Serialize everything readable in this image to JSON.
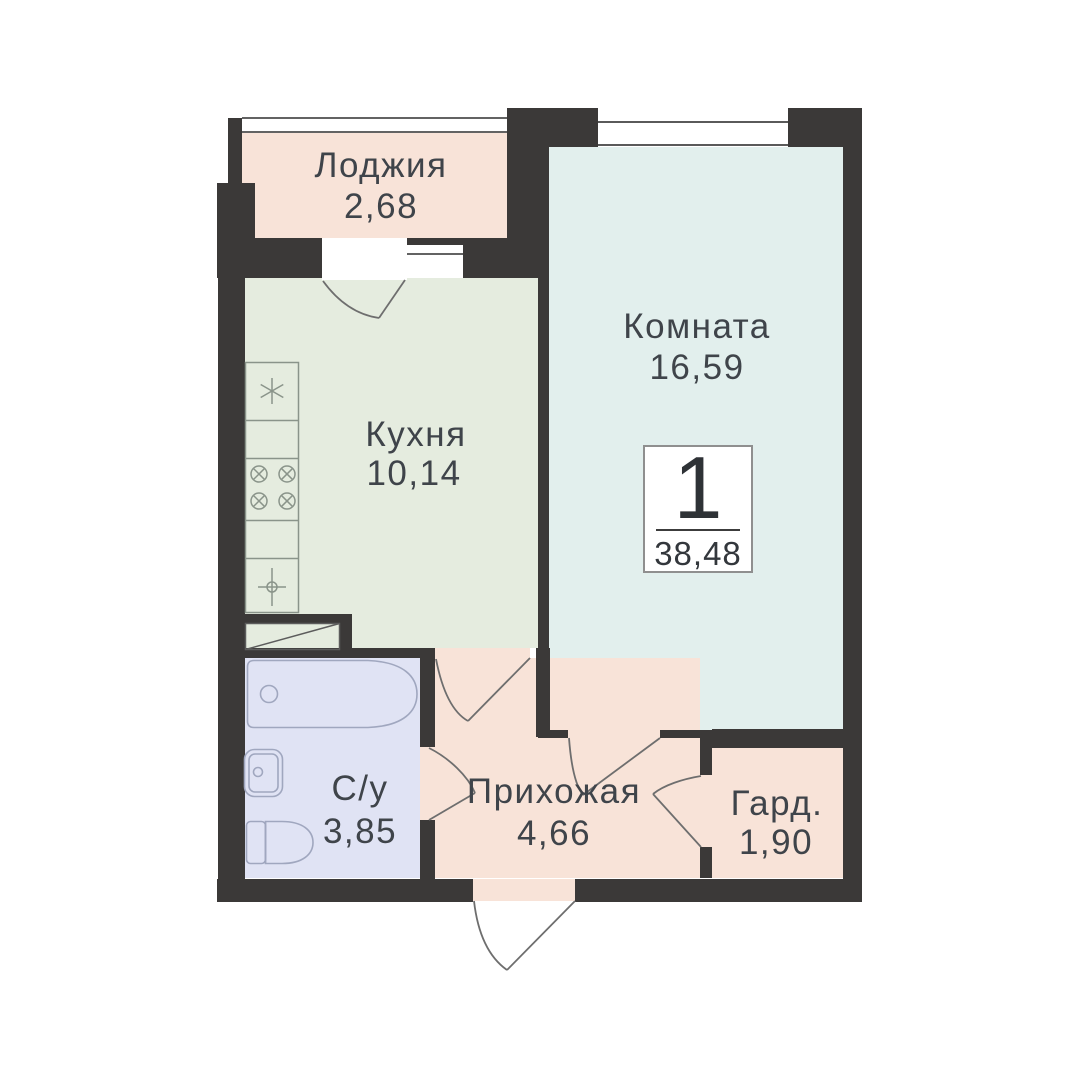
{
  "plan": {
    "type": "apartment-floor-plan",
    "badge": {
      "rooms_count": "1",
      "total_area": "38,48"
    },
    "rooms": [
      {
        "id": "loggia",
        "name": "Лоджия",
        "area": "2,68"
      },
      {
        "id": "room",
        "name": "Комната",
        "area": "16,59"
      },
      {
        "id": "kitchen",
        "name": "Кухня",
        "area": "10,14"
      },
      {
        "id": "bathroom",
        "name": "С/у",
        "area": "3,85"
      },
      {
        "id": "hallway",
        "name": "Прихожая",
        "area": "4,66"
      },
      {
        "id": "wardrobe",
        "name": "Гард.",
        "area": "1,90"
      }
    ],
    "colors": {
      "wall": "#3b3938",
      "loggia": "#f8e3d8",
      "room": "#e2efed",
      "kitchen": "#e5ecdf",
      "bathroom": "#e0e3f4",
      "hallway": "#f8e3d8",
      "wardrobe": "#f8e3d8",
      "text": "#3f444a",
      "door_line": "#6e6e6e",
      "kitchen_fixture_line": "#8a948a",
      "bath_fixture_line": "#a0a7bf"
    }
  }
}
